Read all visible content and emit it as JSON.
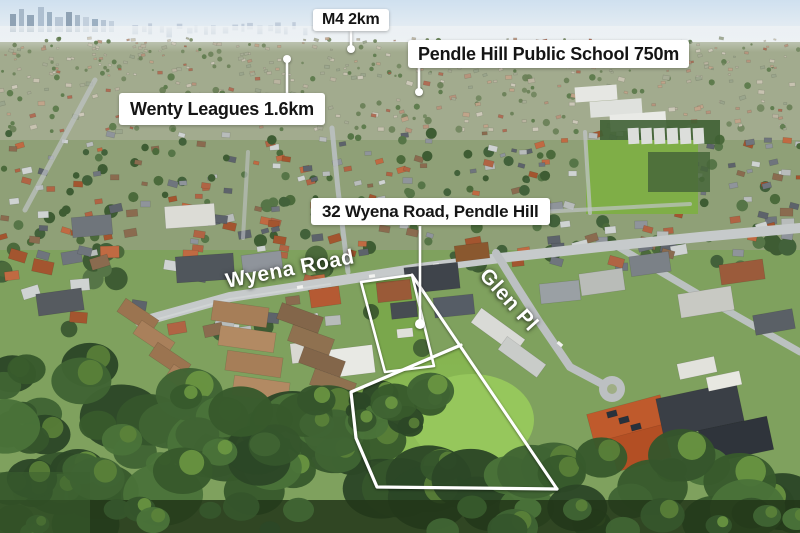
{
  "poi_labels": {
    "m4": "M4 2km",
    "school": "Pendle Hill Public School 750m",
    "wenty": "Wenty Leagues 1.6km",
    "address": "32 Wyena Road, Pendle Hill"
  },
  "road_labels": {
    "wyena": "Wyena Road",
    "glen": "Glen Pl"
  },
  "colors": {
    "label_background": "#ffffff",
    "label_text": "#151515",
    "boundary_line": "#ffffff",
    "road_label_text": "#ffffff",
    "lawn_green": "#8ec457",
    "canopy_green": "#3c5a2d",
    "road_grey": "#c6cacb",
    "sky_blue": "#d7e5f1"
  }
}
